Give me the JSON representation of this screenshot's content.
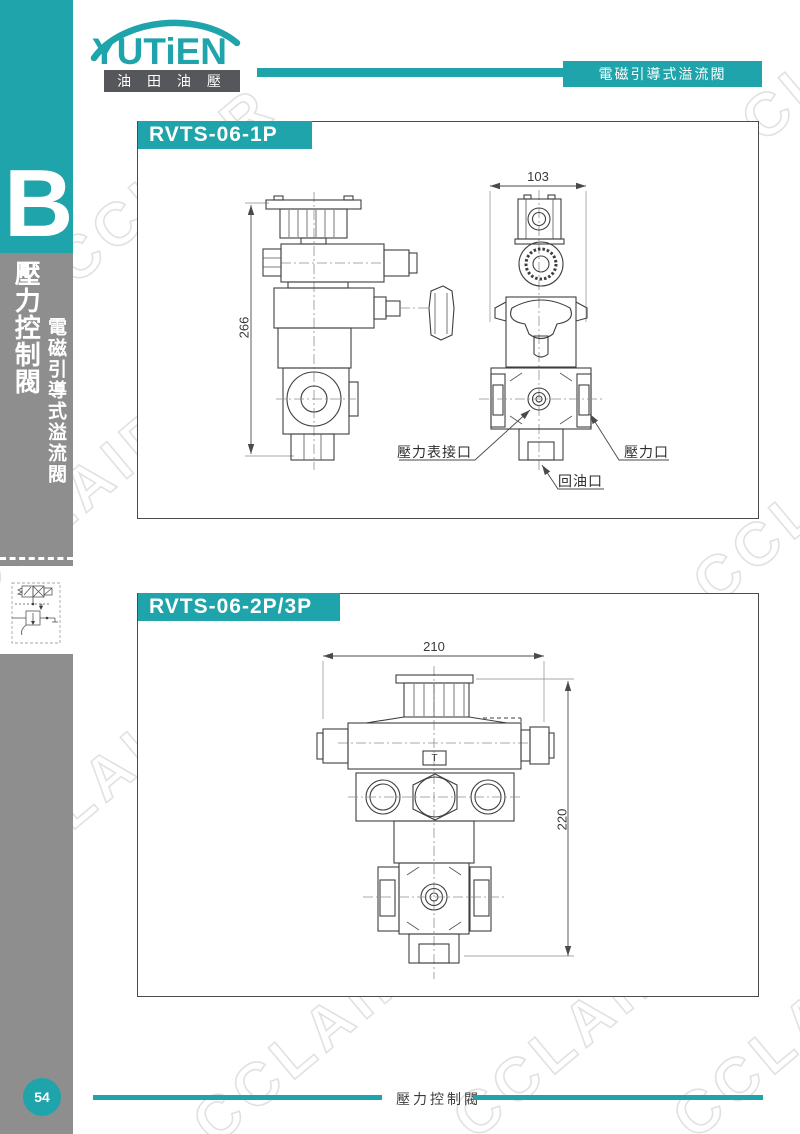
{
  "colors": {
    "teal": "#1ea4aa",
    "sidebar_gray": "#8e8e8e",
    "logo_bar_gray": "#56575b"
  },
  "brand": {
    "logo_text": "YUTiEN",
    "logo_subtitle": "油 田 油 壓"
  },
  "header": {
    "category_tab": "電磁引導式溢流閥"
  },
  "sidebar": {
    "section_letter": "B",
    "main_title": "壓力控制閥",
    "sub_title": "電磁引導式溢流閥"
  },
  "watermark": {
    "text": "CCLAIR"
  },
  "section1": {
    "title": "RVTS-06-1P",
    "front_view": {
      "height_dim": "266"
    },
    "side_view": {
      "width_dim": "103",
      "gauge_port_label": "壓力表接口",
      "return_port_label": "回油口",
      "pressure_port_label": "壓力口"
    }
  },
  "section2": {
    "title": "RVTS-06-2P/3P",
    "width_dim": "210",
    "height_dim": "220",
    "body_mark": "T"
  },
  "footer": {
    "page_number": "54",
    "chapter_title": "壓力控制閥"
  }
}
